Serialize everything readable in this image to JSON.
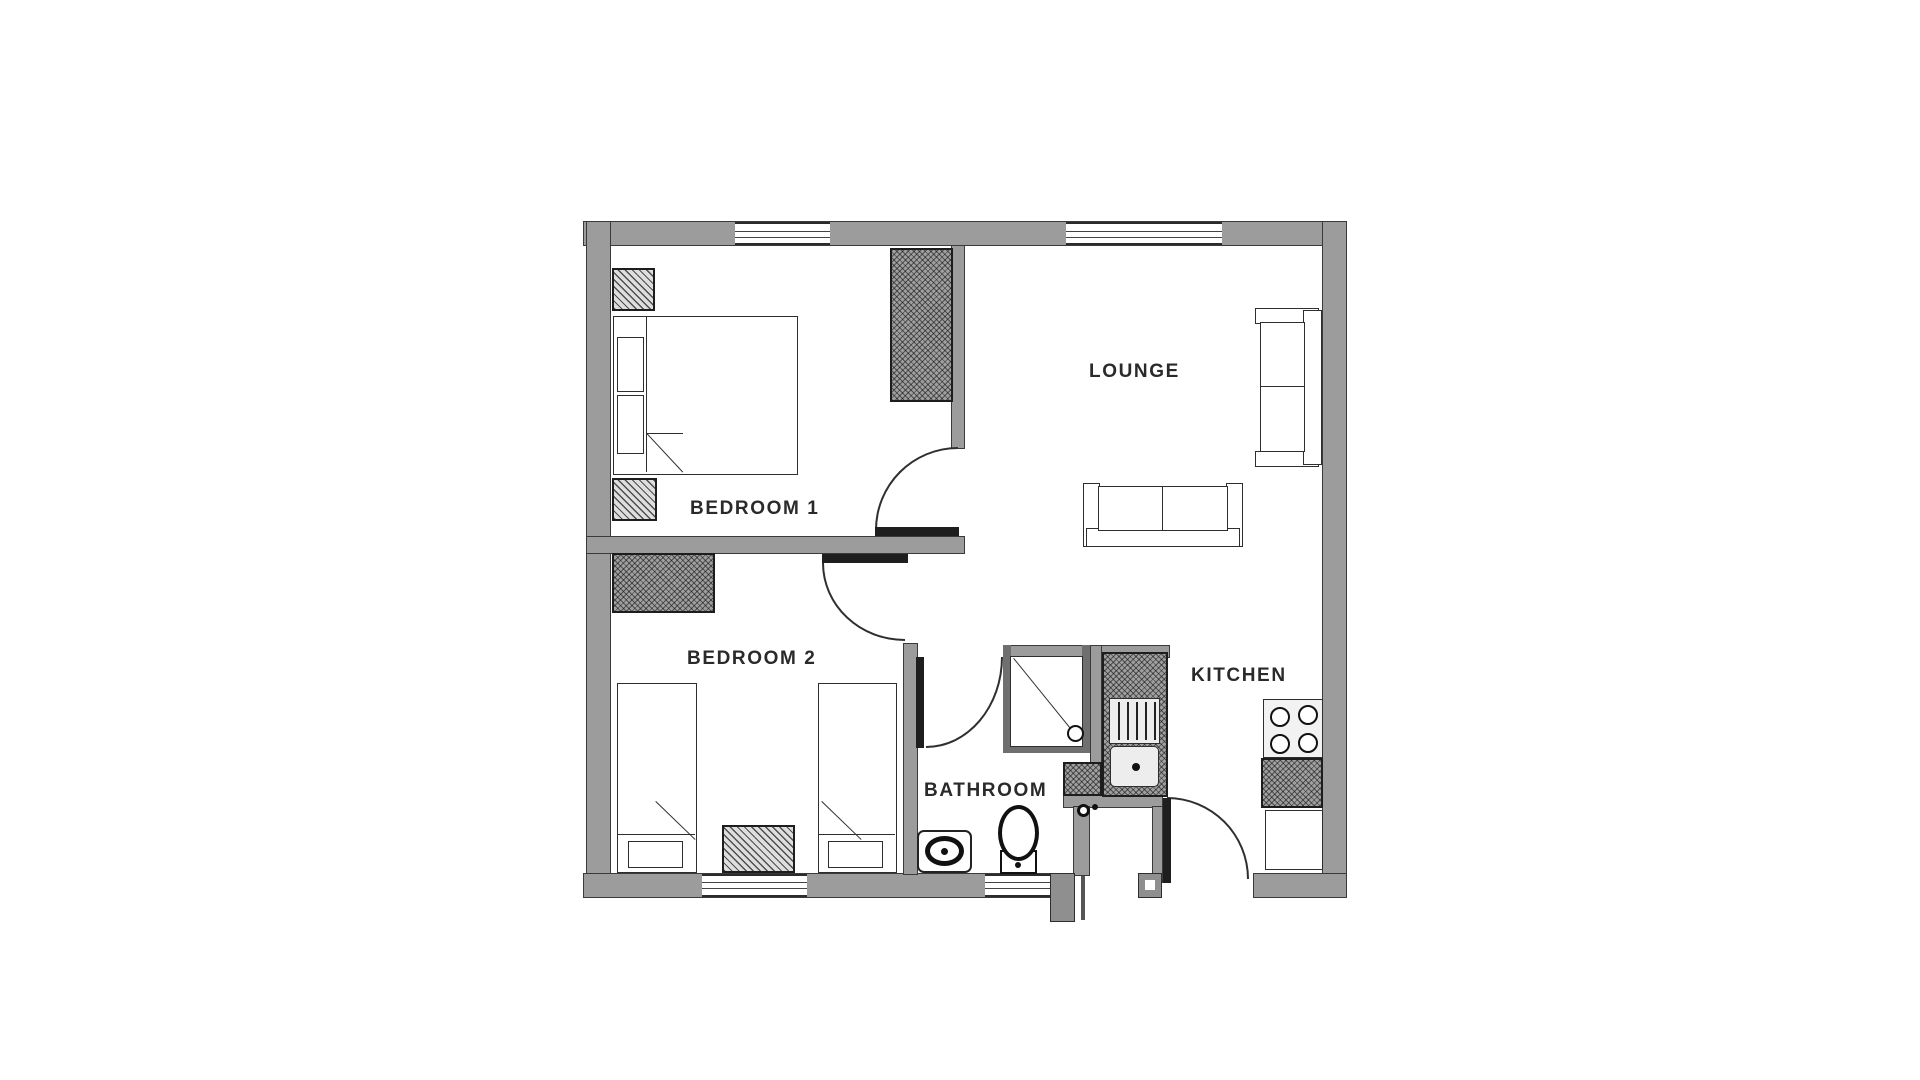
{
  "title": "Two bedroom apartment floor plan",
  "rooms": [
    {
      "id": "bedroom-1",
      "label": "BEDROOM 1"
    },
    {
      "id": "bedroom-2",
      "label": "BEDROOM 2"
    },
    {
      "id": "lounge",
      "label": "LOUNGE"
    },
    {
      "id": "kitchen",
      "label": "KITCHEN"
    },
    {
      "id": "bathroom",
      "label": "BATHROOM"
    }
  ],
  "colors": {
    "background": "#ffffff",
    "wall": "#9c9c9c",
    "outline": "#2e2e2e",
    "door_leaf": "#1e1e1e",
    "label_text": "#2a2a2a",
    "hatch_fill": "#9f9f9f"
  },
  "fixture_symbols": [
    "double-bed",
    "single-bed",
    "wardrobe",
    "bedside-table",
    "rug",
    "sofa",
    "armchair-sofa",
    "window",
    "door-swing",
    "shower",
    "toilet",
    "wash-basin",
    "kitchen-sink-drainer",
    "hob-4-burners",
    "kitchen-counter",
    "base-cabinet",
    "entrance-porch"
  ],
  "window_count": 4,
  "door_count": 6
}
